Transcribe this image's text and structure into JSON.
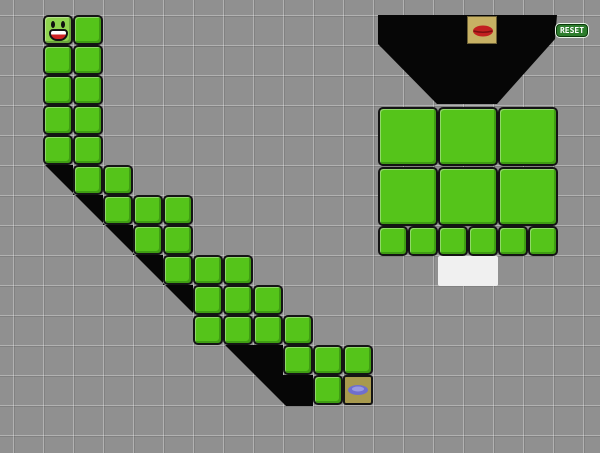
{
  "reset_button": {
    "label": "RESET"
  },
  "colors": {
    "background": "#909090",
    "void_black": "#060606",
    "block_green": "#55c41a",
    "block_border": "#141414",
    "smiley_green": "#8fd44f",
    "lips_tile_bg": "#c7b164",
    "lips_red": "#c22020",
    "lips_dark": "#7c1010",
    "oval_tile_bg": "#a89a4e",
    "oval_blue": "#6f6fce",
    "oval_blue_light": "#9a9ae0",
    "white_block": "#f0f0f0",
    "reset_bg": "#2d7d2d",
    "reset_border": "#0a3a0a",
    "reset_glow": "#e8f5e8",
    "reset_text": "#ffffff"
  },
  "board": {
    "cell_size": 30,
    "origin": {
      "x": 43,
      "y": 15
    },
    "left_structure": {
      "smiley_cell": {
        "col": 1,
        "row": 1
      },
      "green_cells": [
        [
          2,
          1
        ],
        [
          1,
          2
        ],
        [
          2,
          2
        ],
        [
          1,
          3
        ],
        [
          2,
          3
        ],
        [
          1,
          4
        ],
        [
          2,
          4
        ],
        [
          1,
          5
        ],
        [
          2,
          5
        ],
        [
          2,
          6
        ],
        [
          3,
          6
        ],
        [
          3,
          7
        ],
        [
          4,
          7
        ],
        [
          5,
          7
        ],
        [
          4,
          8
        ],
        [
          5,
          8
        ],
        [
          5,
          9
        ],
        [
          6,
          9
        ],
        [
          7,
          9
        ],
        [
          6,
          10
        ],
        [
          7,
          10
        ],
        [
          8,
          10
        ],
        [
          6,
          11
        ],
        [
          7,
          11
        ],
        [
          8,
          11
        ],
        [
          9,
          11
        ],
        [
          9,
          12
        ],
        [
          10,
          12
        ],
        [
          11,
          12
        ],
        [
          10,
          13
        ]
      ],
      "oval_tile_cell": {
        "col": 11,
        "row": 13
      },
      "shadow_polygon": "45,165 73,165 73,195 103,195 103,225 133,225 133,255 163,255 163,285 193,285 193,313 225,345 283,345 283,375 313,375 313,406 286,406"
    },
    "right_structure": {
      "funnel_polygon": "378,15 557,15 555,39 497,104 437,104 378,44",
      "lips_tile": {
        "x": 467,
        "y": 16,
        "w": 30,
        "h": 28
      },
      "large_blocks": [
        {
          "x": 378,
          "y": 107
        },
        {
          "x": 438,
          "y": 107
        },
        {
          "x": 498,
          "y": 107
        },
        {
          "x": 378,
          "y": 167
        },
        {
          "x": 438,
          "y": 167
        },
        {
          "x": 498,
          "y": 167
        }
      ],
      "large_block_size": {
        "w": 60,
        "h": 59
      },
      "small_blocks": [
        {
          "x": 378,
          "y": 226
        },
        {
          "x": 408,
          "y": 226
        },
        {
          "x": 438,
          "y": 226
        },
        {
          "x": 468,
          "y": 226
        },
        {
          "x": 498,
          "y": 226
        },
        {
          "x": 528,
          "y": 226
        }
      ],
      "small_block_size": {
        "w": 30,
        "h": 30
      },
      "white_block": {
        "x": 438,
        "y": 256,
        "w": 60,
        "h": 30
      }
    },
    "reset_button_pos": {
      "x": 556,
      "y": 24,
      "w": 32,
      "h": 13
    }
  }
}
